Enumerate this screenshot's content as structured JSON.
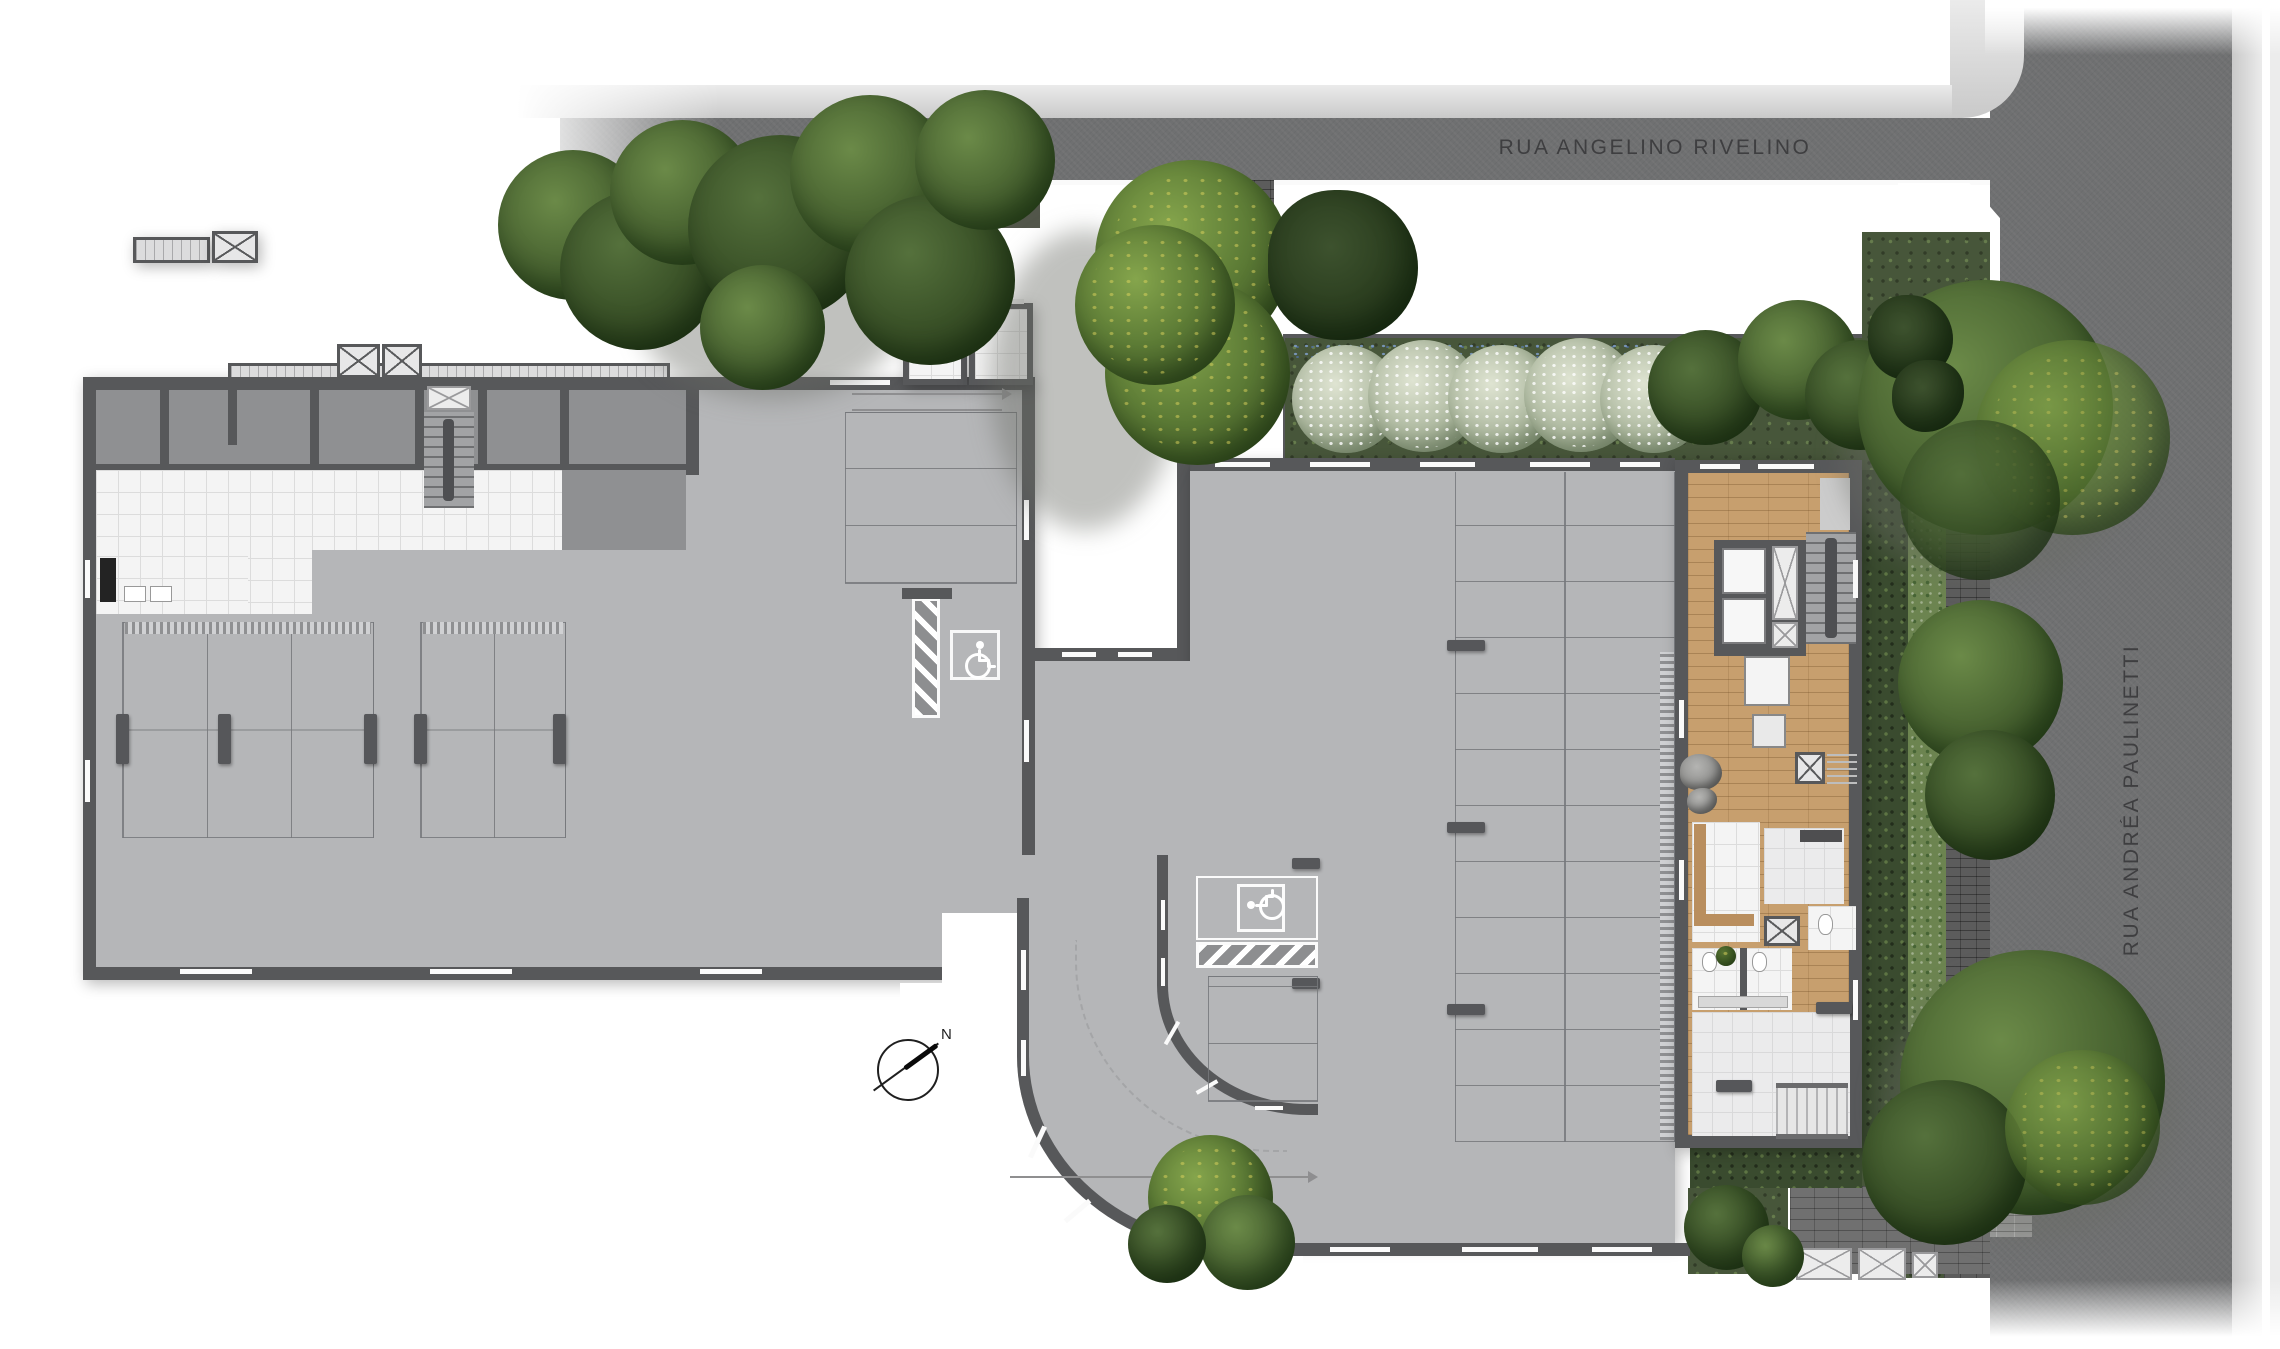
{
  "page": {
    "type": "architectural-site-plan",
    "level": "ground-floor-garage"
  },
  "streets": {
    "top_label": "RUA ANGELINO RIVELINO",
    "right_label": "RUA ANDRÉA PAULINETTI"
  },
  "compass": {
    "north_label": "N"
  },
  "icons": {
    "accessible_parking": "wheelchair-icon",
    "elevator": "x-crossed-shaft",
    "count_accessible_spots": 2
  },
  "colors": {
    "asphalt": "#6f7071",
    "sidewalk": "#d9d9d9",
    "wall": "#57585a",
    "garage_floor": "#b5b6b8",
    "unit_floor": "#8f9092",
    "tile": "#f4f4f4",
    "wood_deck": "#c79f6e",
    "garden_green": "#47563a",
    "stripe_white": "#ffffff",
    "label_text": "#38383a"
  }
}
